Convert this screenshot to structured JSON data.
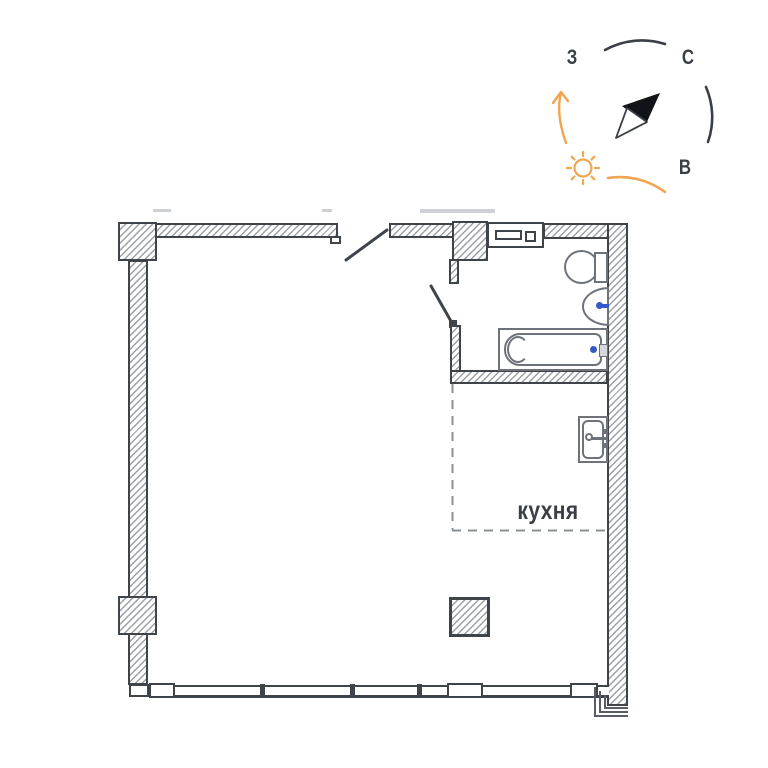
{
  "compass": {
    "west_label": "З",
    "north_label": "С",
    "east_label": "В"
  },
  "plan": {
    "kitchen_label": "кухня"
  },
  "colors": {
    "wall": "#3f444b",
    "hatch": "#9aa0a8",
    "fixture": "#6e737b",
    "dashed": "#8b9097",
    "accent": "#efa552",
    "faucet": "#3558c8",
    "text": "#3a3f47"
  },
  "icons": {
    "sun": "sun-icon",
    "needle": "compass-needle-icon",
    "rotation_arrow": "rotation-arrow-icon"
  }
}
